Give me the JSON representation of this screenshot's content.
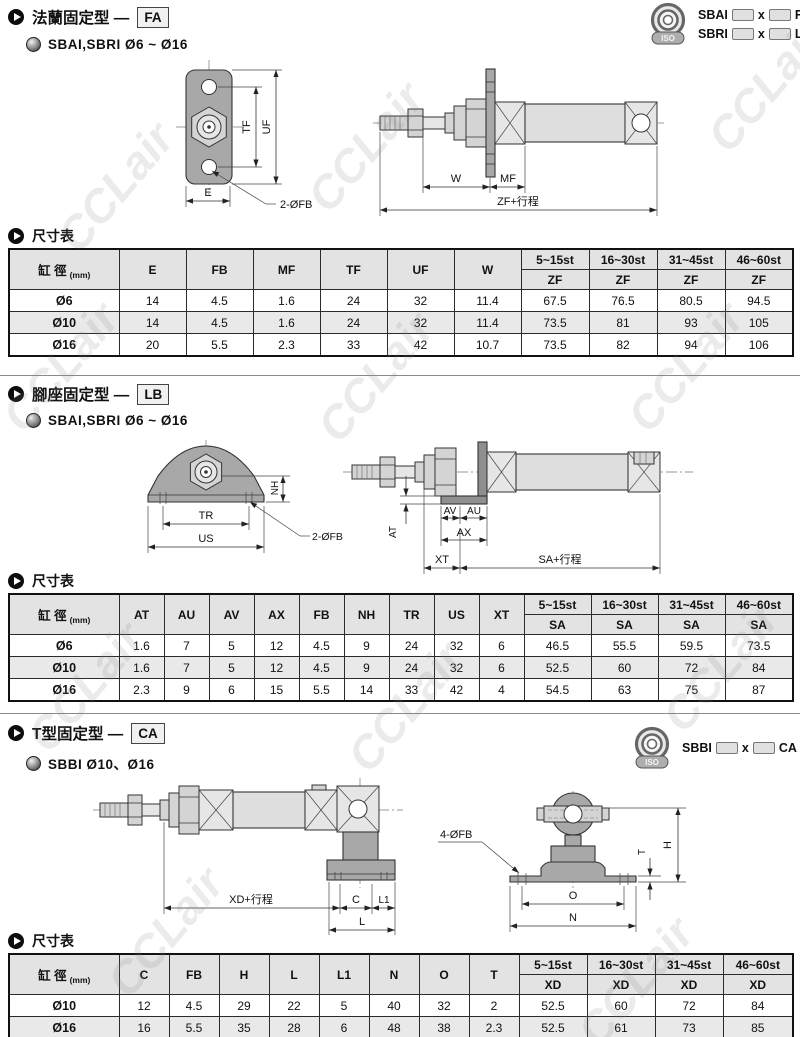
{
  "watermark": "CCLair",
  "logo_text": "ISO",
  "sections": [
    {
      "title": "法蘭固定型 —",
      "code": "FA",
      "subtitle": "SBAI,SBRI Ø6 ~ Ø16",
      "order_code": {
        "lines": [
          {
            "model": "SBAI",
            "sep": "x",
            "mount": "FA"
          },
          {
            "model": "SBRI",
            "sep": "x",
            "mount": "LB"
          }
        ]
      },
      "drawing_front": {
        "labels": {
          "tf": "TF",
          "uf": "UF",
          "e": "E",
          "holes": "2-ØFB"
        }
      },
      "drawing_side": {
        "labels": {
          "w": "W",
          "mf": "MF",
          "total": "ZF+行程"
        }
      },
      "table_heading": "尺寸表",
      "table": {
        "bore_label": "缸 徑",
        "bore_unit": "(mm)",
        "dim_headers": [
          "E",
          "FB",
          "MF",
          "TF",
          "UF",
          "W"
        ],
        "stroke_groups": [
          "5~15st",
          "16~30st",
          "31~45st",
          "46~60st"
        ],
        "stroke_dim": "ZF",
        "rows": [
          {
            "bore": "Ø6",
            "values": [
              "14",
              "4.5",
              "1.6",
              "24",
              "32",
              "11.4",
              "67.5",
              "76.5",
              "80.5",
              "94.5"
            ]
          },
          {
            "bore": "Ø10",
            "values": [
              "14",
              "4.5",
              "1.6",
              "24",
              "32",
              "11.4",
              "73.5",
              "81",
              "93",
              "105"
            ]
          },
          {
            "bore": "Ø16",
            "values": [
              "20",
              "5.5",
              "2.3",
              "33",
              "42",
              "10.7",
              "73.5",
              "82",
              "94",
              "106"
            ]
          }
        ]
      }
    },
    {
      "title": "腳座固定型 —",
      "code": "LB",
      "subtitle": "SBAI,SBRI Ø6 ~ Ø16",
      "drawing_front": {
        "labels": {
          "nh": "NH",
          "tr": "TR",
          "us": "US",
          "holes": "2-ØFB"
        }
      },
      "drawing_side": {
        "labels": {
          "at": "AT",
          "av": "AV",
          "au": "AU",
          "ax": "AX",
          "xt": "XT",
          "total": "SA+行程"
        }
      },
      "table_heading": "尺寸表",
      "table": {
        "bore_label": "缸 徑",
        "bore_unit": "(mm)",
        "dim_headers": [
          "AT",
          "AU",
          "AV",
          "AX",
          "FB",
          "NH",
          "TR",
          "US",
          "XT"
        ],
        "stroke_groups": [
          "5~15st",
          "16~30st",
          "31~45st",
          "46~60st"
        ],
        "stroke_dim": "SA",
        "rows": [
          {
            "bore": "Ø6",
            "values": [
              "1.6",
              "7",
              "5",
              "12",
              "4.5",
              "9",
              "24",
              "32",
              "6",
              "46.5",
              "55.5",
              "59.5",
              "73.5"
            ]
          },
          {
            "bore": "Ø10",
            "values": [
              "1.6",
              "7",
              "5",
              "12",
              "4.5",
              "9",
              "24",
              "32",
              "6",
              "52.5",
              "60",
              "72",
              "84"
            ]
          },
          {
            "bore": "Ø16",
            "values": [
              "2.3",
              "9",
              "6",
              "15",
              "5.5",
              "14",
              "33",
              "42",
              "4",
              "54.5",
              "63",
              "75",
              "87"
            ]
          }
        ]
      }
    },
    {
      "title": "T型固定型 —",
      "code": "CA",
      "subtitle": "SBBI Ø10、Ø16",
      "order_code": {
        "lines": [
          {
            "model": "SBBI",
            "sep": "x",
            "mount": "CA"
          }
        ]
      },
      "drawing_side": {
        "labels": {
          "total": "XD+行程",
          "c": "C",
          "l1": "L1",
          "l": "L"
        }
      },
      "drawing_front": {
        "labels": {
          "holes": "4-ØFB",
          "t": "T",
          "h": "H",
          "o": "O",
          "n": "N"
        }
      },
      "table_heading": "尺寸表",
      "table": {
        "bore_label": "缸 徑",
        "bore_unit": "(mm)",
        "dim_headers": [
          "C",
          "FB",
          "H",
          "L",
          "L1",
          "N",
          "O",
          "T"
        ],
        "stroke_groups": [
          "5~15st",
          "16~30st",
          "31~45st",
          "46~60st"
        ],
        "stroke_dim": "XD",
        "rows": [
          {
            "bore": "Ø10",
            "values": [
              "12",
              "4.5",
              "29",
              "22",
              "5",
              "40",
              "32",
              "2",
              "52.5",
              "60",
              "72",
              "84"
            ]
          },
          {
            "bore": "Ø16",
            "values": [
              "16",
              "5.5",
              "35",
              "28",
              "6",
              "48",
              "38",
              "2.3",
              "52.5",
              "61",
              "73",
              "85"
            ]
          }
        ]
      }
    }
  ]
}
